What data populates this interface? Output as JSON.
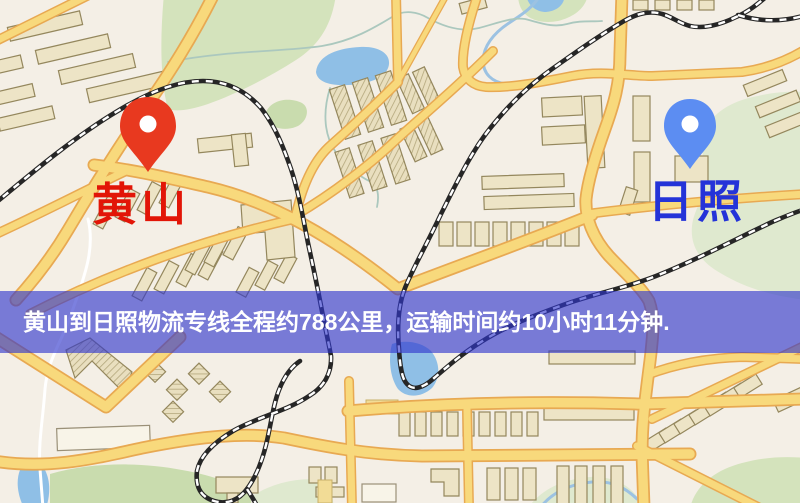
{
  "window": {
    "width": 800,
    "height": 503
  },
  "map": {
    "origin": {
      "name": "黄山",
      "pin_icon": "red-map-pin",
      "pin_color": "#E8391F",
      "label_color": "#E21507"
    },
    "destination": {
      "name": "日照",
      "pin_icon": "blue-map-pin",
      "pin_color": "#5C8DF2",
      "label_color": "#2433D8"
    }
  },
  "banner": {
    "text": "黄山到日照物流专线全程约788公里，运输时间约10小时11分钟.",
    "background": "rgba(47,54,205,0.63)",
    "text_color": "#FFFFFF"
  },
  "route": {
    "from": "黄山",
    "to": "日照",
    "service": "物流专线",
    "distance_text": "约788公里",
    "duration_text": "约10小时11分钟"
  },
  "map_colors": {
    "background": "#F4EFE6",
    "road_fill": "#F8D97C",
    "road_casing": "#E8A952",
    "building": "#EDE4C6",
    "park": "#D4E3BC",
    "water": "#8FBFE6",
    "railway": "#262626"
  }
}
